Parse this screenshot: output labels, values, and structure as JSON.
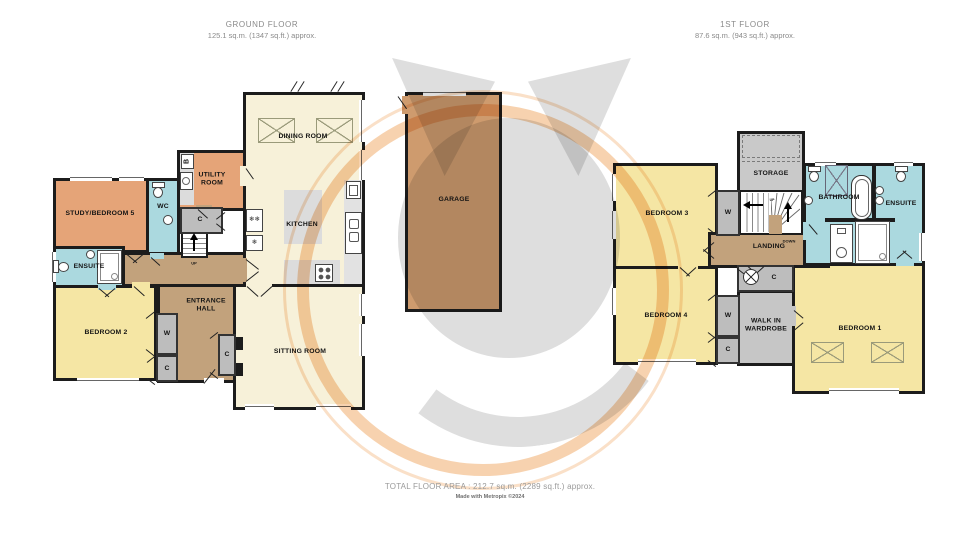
{
  "meta": {
    "ground_title": "GROUND FLOOR",
    "ground_area": "125.1 sq.m. (1347 sq.ft.) approx.",
    "first_title": "1ST FLOOR",
    "first_area": "87.6 sq.m. (943 sq.ft.) approx.",
    "total": "TOTAL FLOOR AREA : 212.7 sq.m. (2289 sq.ft.) approx.",
    "credit": "Made with Metropix ©2024"
  },
  "ground": {
    "dining": "DINING ROOM",
    "kitchen": "KITCHEN",
    "utility": "UTILITY\nROOM",
    "study": "STUDY/BEDROOM 5",
    "wc": "WC",
    "ensuite": "ENSUITE",
    "bedroom2": "BEDROOM 2",
    "hall": "ENTRANCE\nHALL",
    "sitting": "SITTING ROOM",
    "garage": "GARAGE",
    "c1": "C",
    "w1": "W",
    "c2": "C",
    "c3": "C",
    "boiler": "B",
    "up": "UP"
  },
  "first": {
    "bedroom3": "BEDROOM 3",
    "storage": "STORAGE",
    "landing": "LANDING",
    "bathroom": "BATHROOM",
    "ensuite": "ENSUITE",
    "bedroom4": "BEDROOM 4",
    "walkin": "WALK IN\nWARDROBE",
    "bedroom1": "BEDROOM 1",
    "w1": "W",
    "c1": "C",
    "w2": "W",
    "c2": "C",
    "up": "UP",
    "down": "DOWN"
  },
  "icons": {
    "fridge_freezer": "❄❄",
    "fridge": "❄"
  },
  "colors": {
    "bedroom": "#F5E6A4",
    "living": "#F7F1D9",
    "orange": "#E5A478",
    "bath": "#ABD9DF",
    "hall": "#C2A27C",
    "cupboard": "#BDBDBD",
    "garage": "#CE9B6E",
    "wall": "#1C1C1C",
    "accent": "#F0A660"
  }
}
